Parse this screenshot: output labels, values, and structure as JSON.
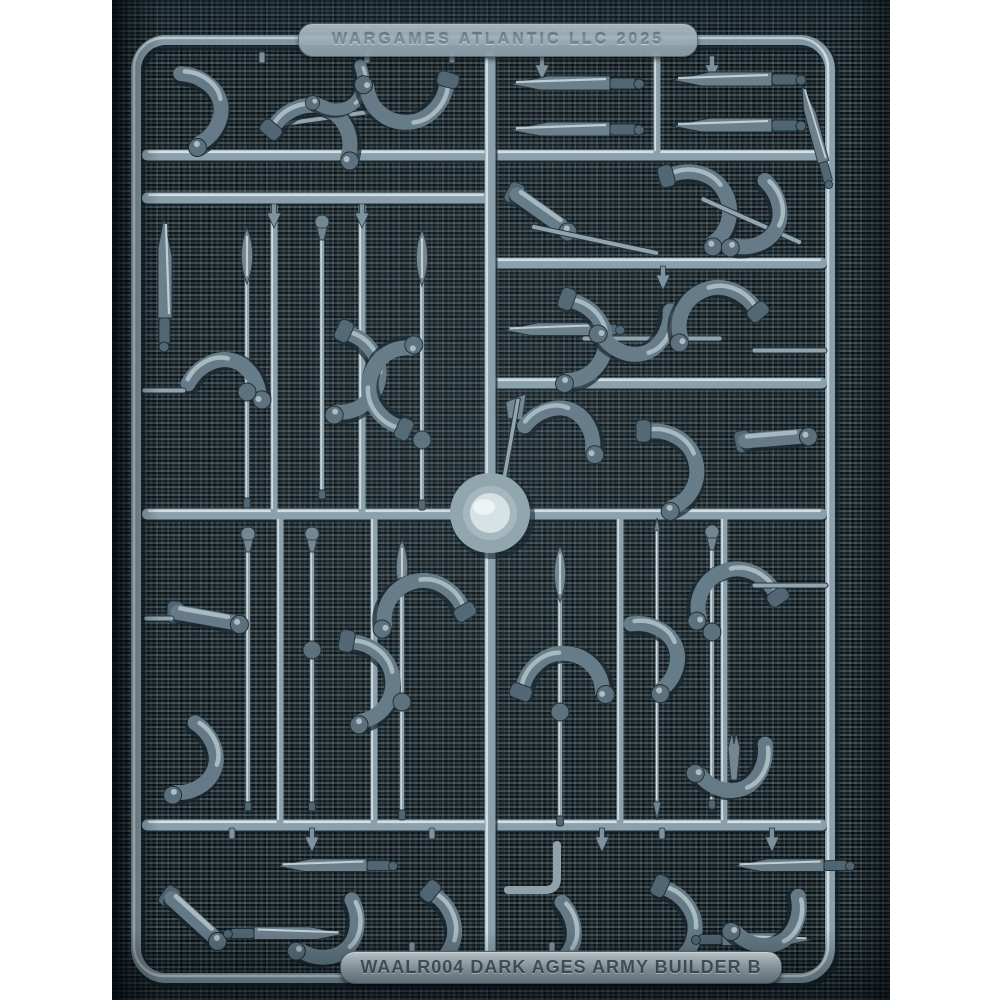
{
  "scene": {
    "type": "photograph of a plastic miniature sprue on dark woven cloth",
    "top_label_text": "WARGAMES ATLANTIC LLC 2025",
    "bottom_label_text": "WAALR004 DARK AGES ARMY BUILDER B",
    "colors": {
      "backdrop_weave": "#202c32",
      "plastic_mid": "#8ba0ab",
      "plastic_highlight": "#dde8ed",
      "plastic_shadow": "#16232a",
      "page_margin": "#ffffff"
    },
    "sprue_contents": {
      "top_left": "bent arms and horn pieces",
      "top_right": "four seax knife blades in two rows",
      "right_rows": "arms holding swords and axes",
      "middle_left": "vertical spears, a knife and gripping arms",
      "lower_left": "spear shafts with finials and arms",
      "lower_right": "leaf spear, javelin, fork tip and arms",
      "bottom_row": "arms holding daggers",
      "center": "round injection hub"
    }
  }
}
